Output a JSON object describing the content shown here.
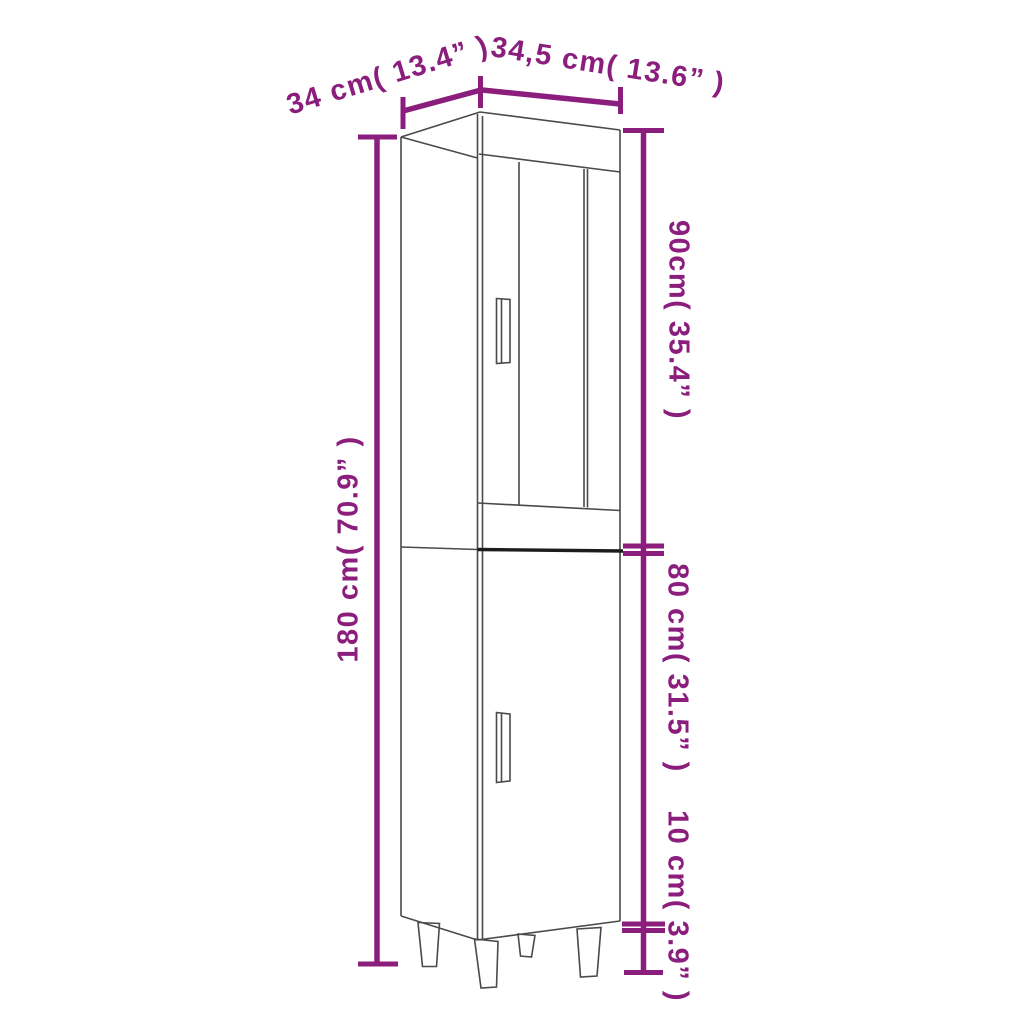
{
  "diagram": {
    "type": "furniture-dimension-diagram",
    "accent_color": "#8b1e7d",
    "outline_color": "#4a4a4a",
    "divider_color": "#1c1c1c",
    "background_color": "#ffffff",
    "labels": {
      "depth": "34 cm( 13.4” )",
      "width": "34,5 cm( 13.6” )",
      "total_height": "180 cm( 70.9” )",
      "upper_section_height": "90cm( 35.4” )",
      "lower_section_height": "80 cm( 31.5” )",
      "leg_height": "10 cm( 3.9” )"
    }
  }
}
